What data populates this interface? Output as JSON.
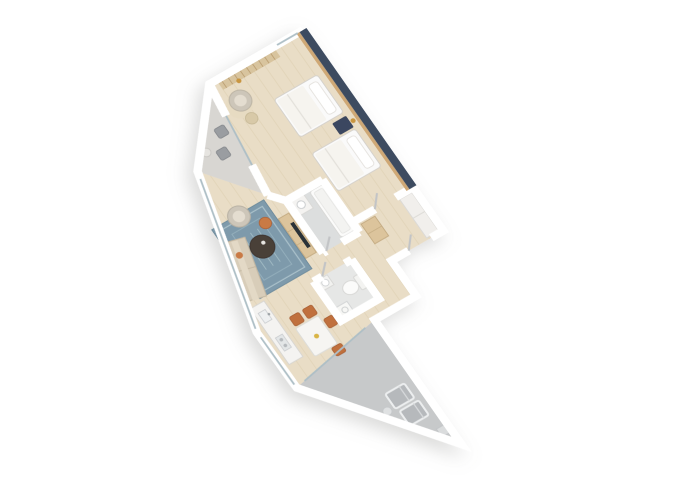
{
  "meta": {
    "title": "3D Apartment Floor Plan",
    "view": "isometric 3D render, no text labels",
    "background": "#ffffff"
  },
  "palette": {
    "wall": "#ffffff",
    "wall_edge": "#c6c8ca",
    "floor_wood": "#e9ddc6",
    "plank_line": "#d9c9ab",
    "accent_wall_navy": "#3e4c61",
    "wood_trim": "#cfa875",
    "tile_gray": "#dcdede",
    "wc_tile": "#e6e7e6",
    "terrace_concrete": "#c7c9ca",
    "balcony_concrete": "#d8d6d2",
    "rug_blue": "#7e9aab",
    "rug_border": "#a9c0c9",
    "rug_inner": "#93aebb",
    "sofa_beige": "#d8cdb9",
    "armchair_gray": "#cdc6b9",
    "armchair_inner": "#e4ddd0",
    "coffee_table_dark": "#4a3f39",
    "accent_orange": "#c97a45",
    "chair_terracotta": "#c0703c",
    "bed_white": "#fafafa",
    "duvet": "#f6f4ef",
    "nightstand_navy": "#3a4760",
    "lamp_gold": "#c9963f",
    "wardrobe_wood": "#d8c49e",
    "wardrobe_slat": "#b89a6d",
    "glass": "#aebfc6",
    "lounger_gray": "#b6b9bc",
    "counter_white": "#f4f3f1",
    "console_wood": "#dcc49c",
    "tv_dark": "#2b3038",
    "fixture_white": "#fbfbfa",
    "bedroom_rug": "#e7dbc2",
    "balcony_chair": "#9a9da1",
    "closet_white": "#f1efec",
    "bowl_yellow": "#d9b544",
    "shadow": "#8d8d8b"
  },
  "rooms": [
    {
      "id": "bedroom",
      "label": "bedroom",
      "furniture": [
        "double-bed",
        "double-bed",
        "nightstand",
        "gold-wall-lamp",
        "slatted-wardrobe",
        "round-armchair",
        "pouf",
        "round-rug",
        "gold-floor-lamp"
      ],
      "features": [
        "navy-accent-wall",
        "wood-trim",
        "window-wall",
        "sliding-door-to-balcony"
      ]
    },
    {
      "id": "balcony",
      "label": "balcony",
      "furniture": [
        "outdoor-chair",
        "outdoor-chair",
        "side-table"
      ],
      "features": [
        "triangular-shape",
        "concrete-floor",
        "parapet"
      ]
    },
    {
      "id": "living-room",
      "label": "living-room",
      "furniture": [
        "blue-patterned-rug",
        "beige-sofa",
        "gray-armchair",
        "dark-round-coffee-table",
        "orange-pouf",
        "tv-console",
        "tv"
      ],
      "features": [
        "slanted-window-wall",
        "open-plan"
      ]
    },
    {
      "id": "bathroom",
      "label": "bathroom",
      "furniture": [
        "bathtub",
        "vanity-sink"
      ],
      "features": [
        "gray-tile-floor",
        "door-to-hallway"
      ]
    },
    {
      "id": "hallway-entry",
      "label": "hallway-entry",
      "furniture": [
        "wall-closet",
        "console-cabinet"
      ],
      "features": [
        "entry-door"
      ]
    },
    {
      "id": "wc",
      "label": "wc",
      "furniture": [
        "toilet",
        "small-sink",
        "washing-machine"
      ],
      "features": [
        "tile-floor",
        "door-to-corridor"
      ]
    },
    {
      "id": "kitchen-dining",
      "label": "kitchen-dining",
      "furniture": [
        "kitchen-counter",
        "sink",
        "cooktop",
        "dining-table",
        "fruit-bowl",
        "terracotta-chair",
        "terracotta-chair",
        "terracotta-chair",
        "terracotta-chair"
      ],
      "features": [
        "window-wall"
      ]
    },
    {
      "id": "terrace",
      "label": "terrace",
      "furniture": [
        "lounger",
        "lounger",
        "side-table",
        "planter-box"
      ],
      "features": [
        "triangular-shape",
        "concrete-floor",
        "parapet"
      ]
    }
  ]
}
